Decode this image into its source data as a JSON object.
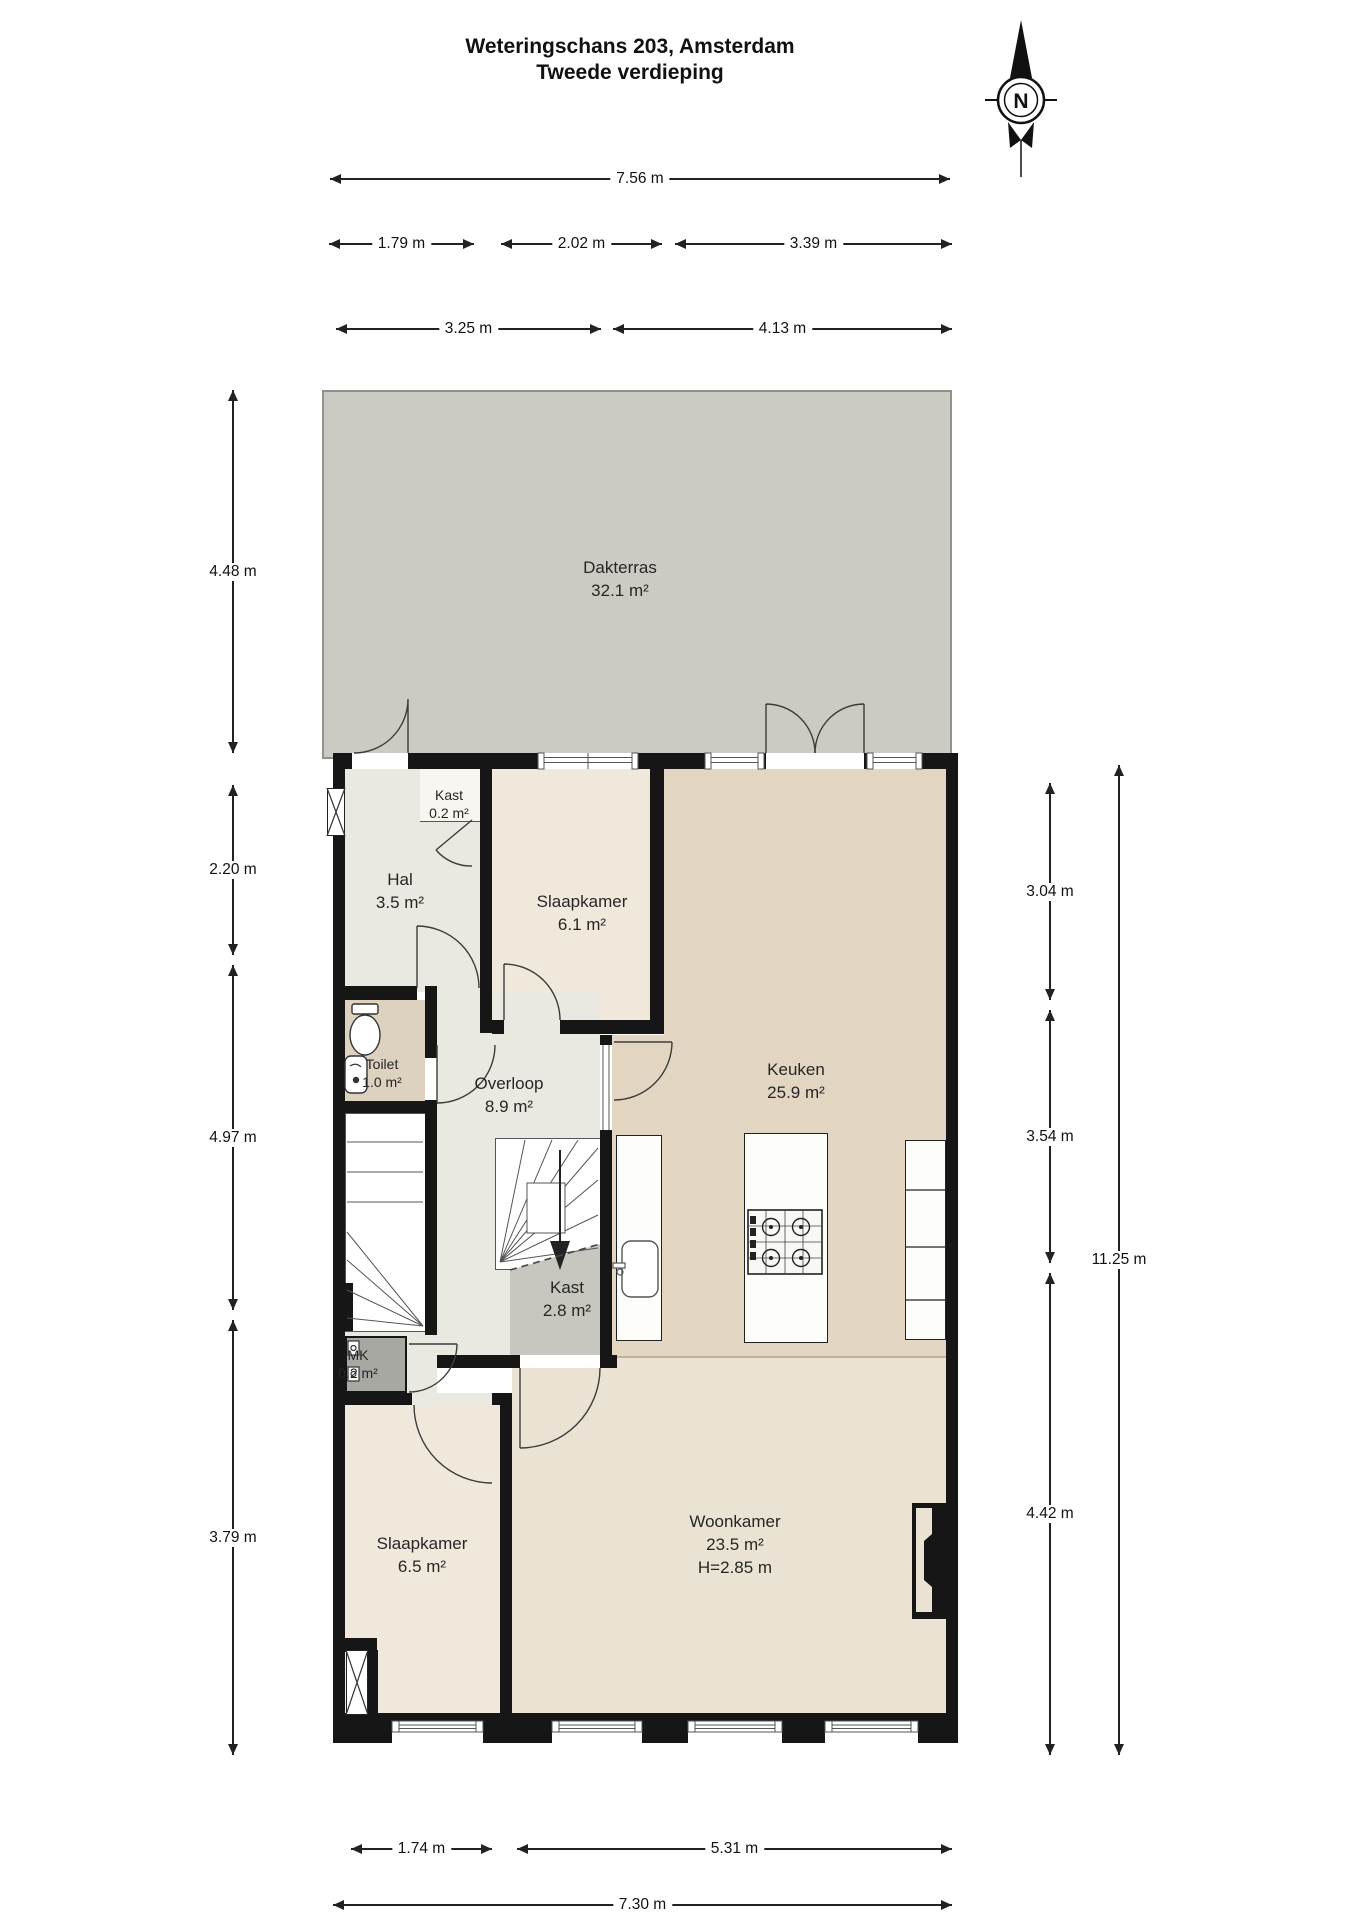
{
  "title": {
    "line1": "Weteringschans 203, Amsterdam",
    "line2": "Tweede verdieping"
  },
  "compass": {
    "north_label": "N"
  },
  "rooms": {
    "dakterras": {
      "name": "Dakterras",
      "area": "32.1 m²"
    },
    "kast_boven": {
      "name": "Kast",
      "area": "0.2 m²"
    },
    "hal": {
      "name": "Hal",
      "area": "3.5 m²"
    },
    "slaapkamer_1": {
      "name": "Slaapkamer",
      "area": "6.1 m²"
    },
    "keuken": {
      "name": "Keuken",
      "area": "25.9 m²"
    },
    "toilet": {
      "name": "Toilet",
      "area": "1.0 m²"
    },
    "overloop": {
      "name": "Overloop",
      "area": "8.9 m²"
    },
    "kast_midden": {
      "name": "Kast",
      "area": "2.8 m²"
    },
    "mk": {
      "name": "MK",
      "area": "0.2 m²"
    },
    "slaapkamer_2": {
      "name": "Slaapkamer",
      "area": "6.5 m²"
    },
    "woonkamer": {
      "name": "Woonkamer",
      "area": "23.5 m²",
      "ceiling_height": "H=2.85 m"
    }
  },
  "dimensions": {
    "top": [
      "7.56 m",
      "1.79 m",
      "2.02 m",
      "3.39 m",
      "3.25 m",
      "4.13 m"
    ],
    "left": [
      "4.48 m",
      "2.20 m",
      "4.97 m",
      "3.79 m"
    ],
    "right": [
      "3.04 m",
      "3.54 m",
      "4.42 m",
      "11.25 m"
    ],
    "bottom": [
      "1.74 m",
      "5.31 m",
      "7.30 m"
    ]
  },
  "colors": {
    "wall": "#161616",
    "dakterras": "#cccbc3",
    "hal_overloop": "#e9e8e1",
    "slaapkamer": "#f0e9db",
    "keuken": "#e2d6c2",
    "toilet": "#ddd1bf",
    "woonkamer": "#eae2d2",
    "kast": "#c7c7bf",
    "mk": "#a8a8a2"
  }
}
